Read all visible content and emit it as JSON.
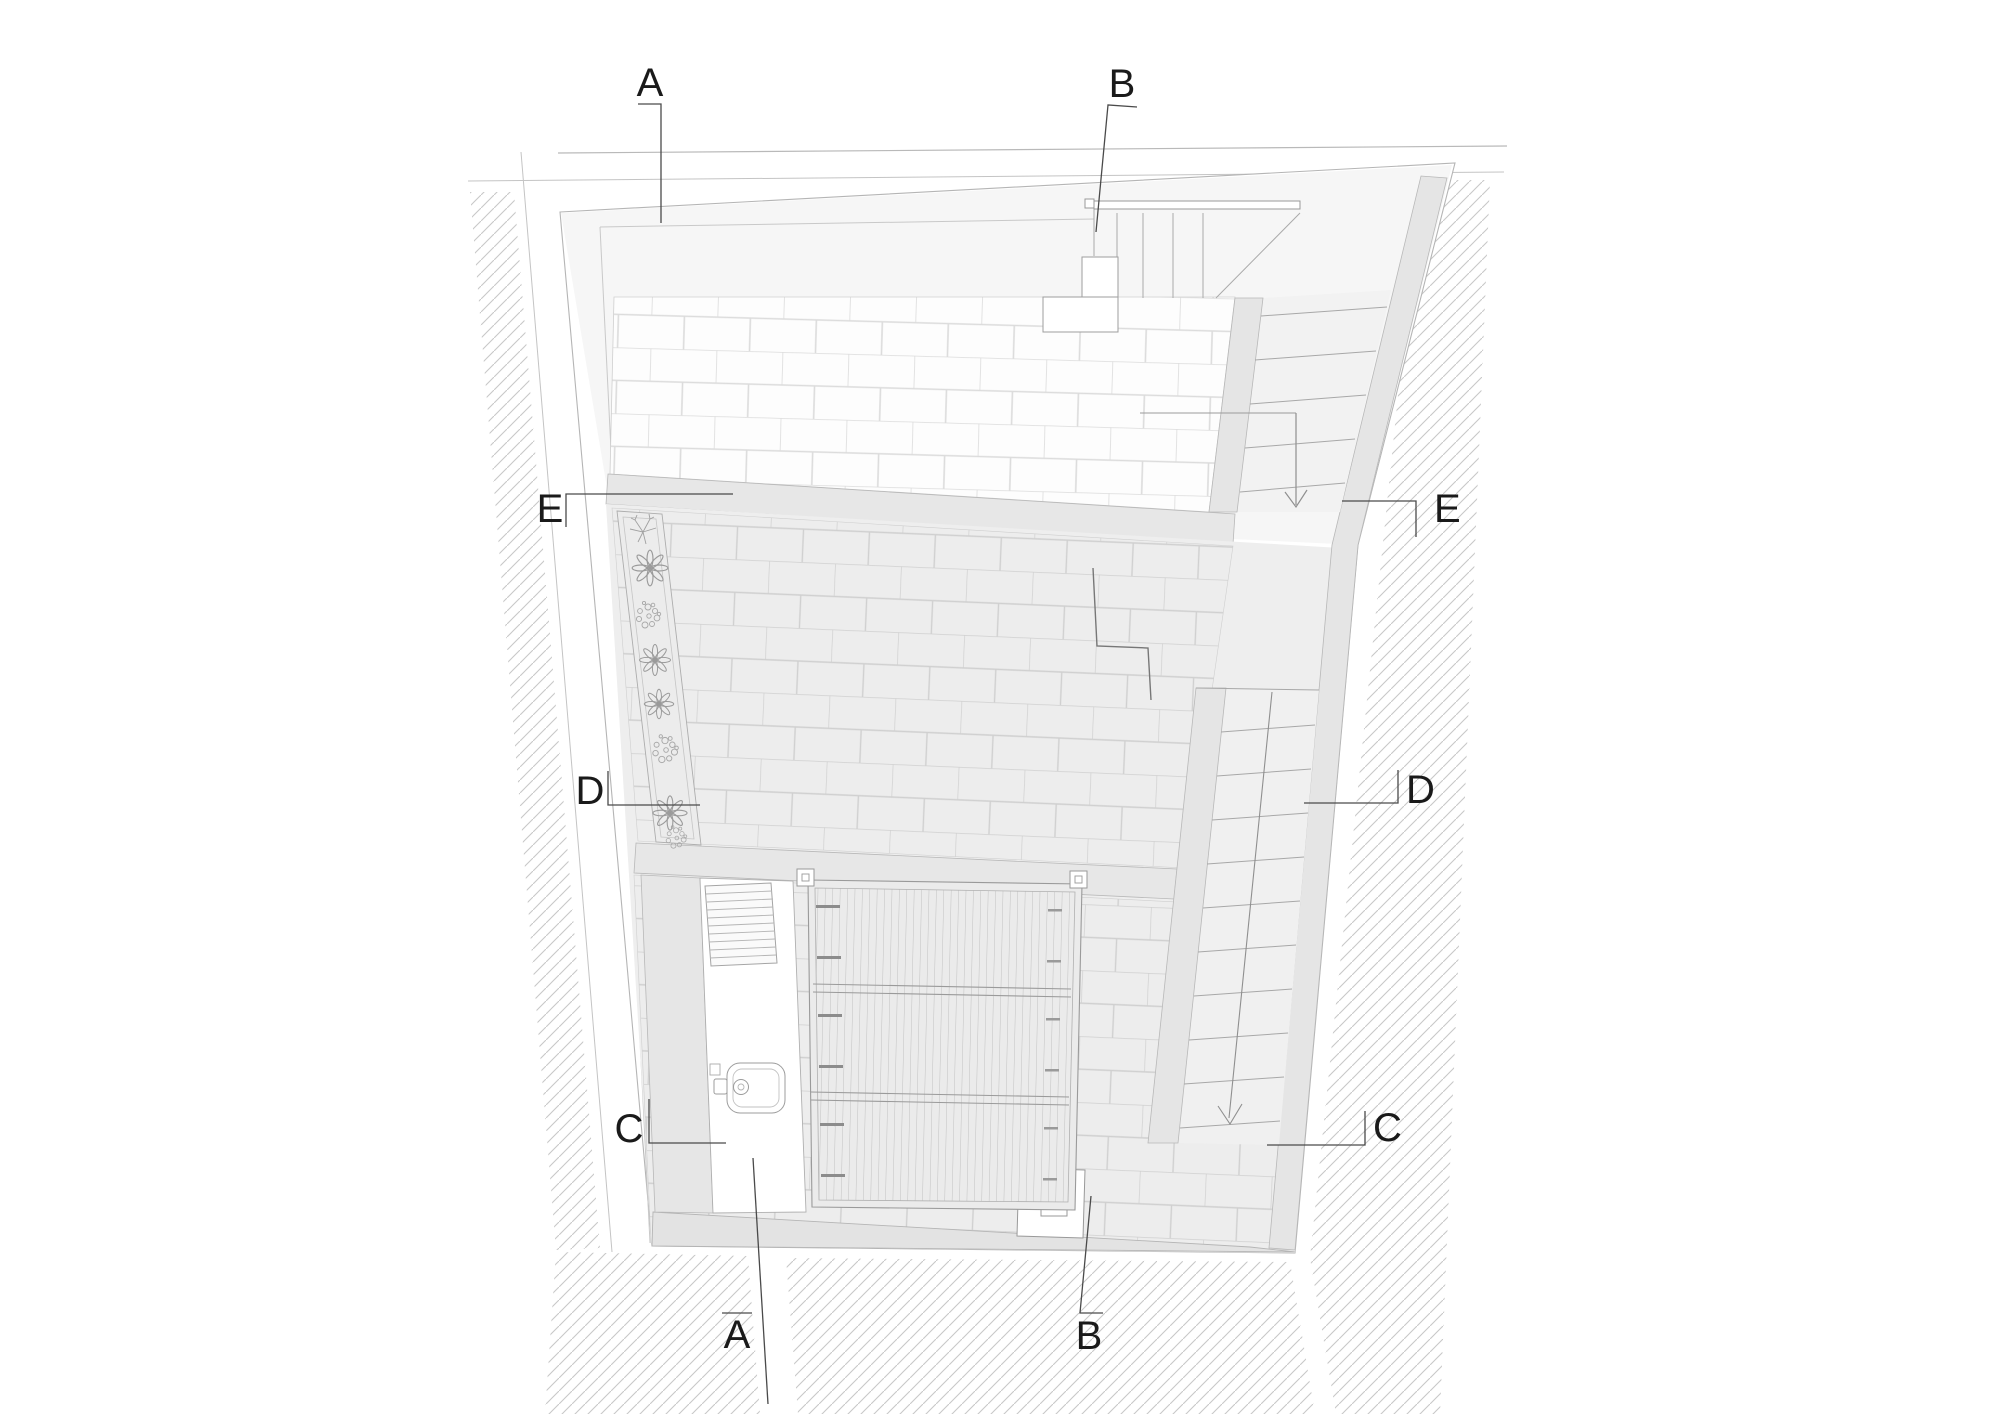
{
  "section_markers": {
    "a_top": "A",
    "b_top": "B",
    "e_left": "E",
    "e_right": "E",
    "d_left": "D",
    "d_right": "D",
    "c_left": "C",
    "c_right": "C",
    "a_bottom": "A",
    "b_bottom": "B"
  },
  "colors": {
    "ink": "#1a1a1a",
    "leader_line": "#4a4a4a",
    "wall_fill": "#e6e6e6",
    "wall_edge": "#b5b5b5",
    "brick_joint_light": "#dcdcdc",
    "brick_joint_mid": "#d0d0d0",
    "hatch_line": "#c8c8c8",
    "paper": "#ffffff"
  }
}
